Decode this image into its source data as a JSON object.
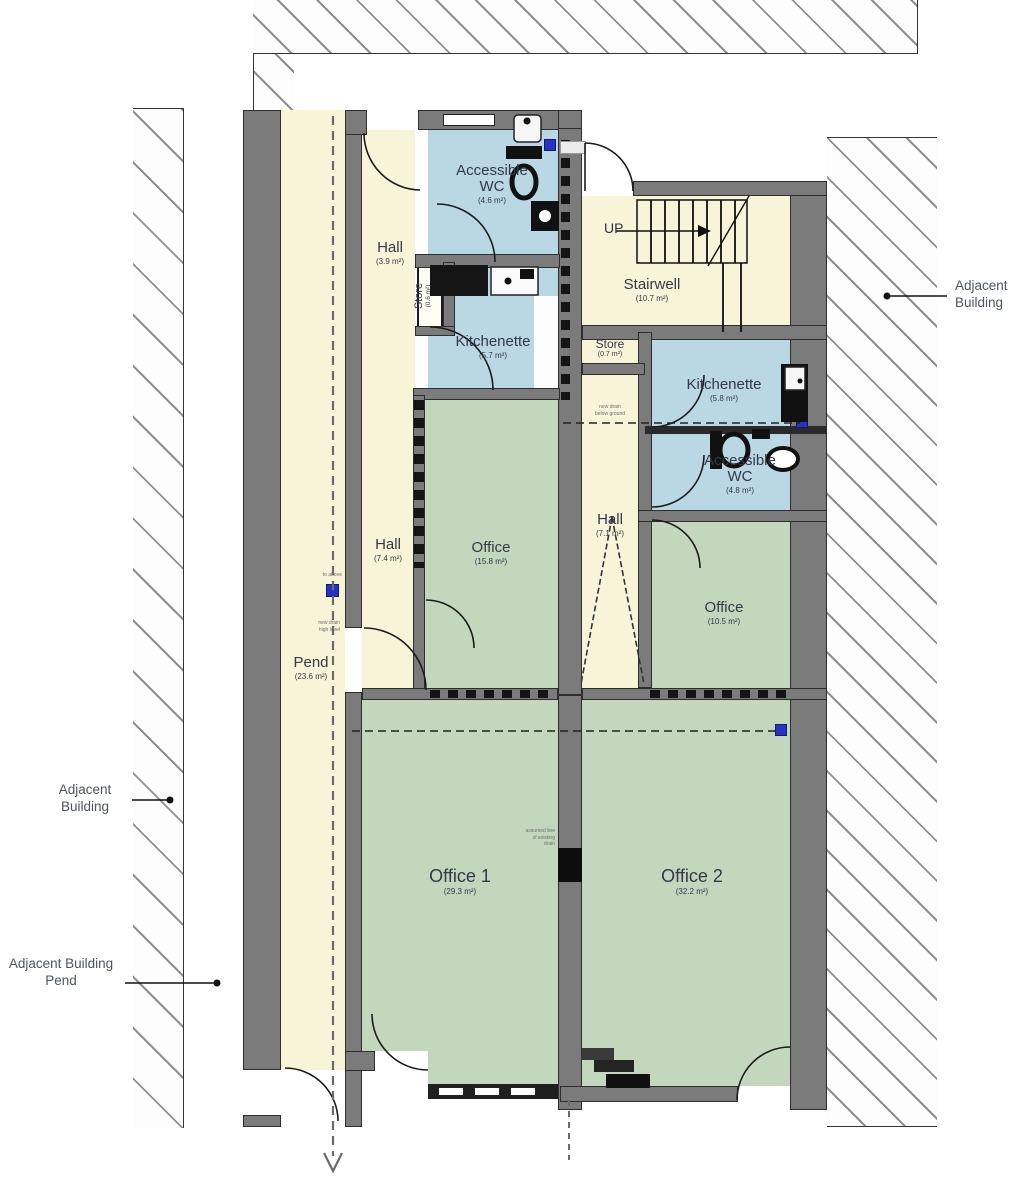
{
  "rooms": {
    "wc1": {
      "name": "Accessible WC",
      "area": "(4.6 m²)"
    },
    "hall1": {
      "name": "Hall",
      "area": "(3.9 m²)"
    },
    "store1": {
      "name": "Store",
      "area": "(0.6 m²)"
    },
    "kitchenette1": {
      "name": "Kitchenette",
      "area": "(5.7 m²)"
    },
    "stairwell": {
      "name": "Stairwell",
      "area": "(10.7 m²)"
    },
    "store2": {
      "name": "Store",
      "area": "(0.7 m²)"
    },
    "kitchenette2": {
      "name": "Kitchenette",
      "area": "(5.8 m²)"
    },
    "wc2": {
      "name": "Accessible WC",
      "area": "(4.8 m²)"
    },
    "hall2": {
      "name": "Hall",
      "area": "(7.4 m²)"
    },
    "office_a": {
      "name": "Office",
      "area": "(15.8 m²)"
    },
    "hall3": {
      "name": "Hall",
      "area": "(7.1 m²)"
    },
    "office_b": {
      "name": "Office",
      "area": "(10.5 m²)"
    },
    "pend": {
      "name": "Pend",
      "area": "(23.6 m²)"
    },
    "office1": {
      "name": "Office 1",
      "area": "(29.3 m²)"
    },
    "office2": {
      "name": "Office 2",
      "area": "(32.2 m²)"
    }
  },
  "annotations": {
    "up": "UP",
    "adjacent_building_left": "Adjacent Building",
    "adjacent_building_right": "Adjacent Building",
    "adjacent_building_pend": "Adjacent Building\nPend",
    "to_above": "to above",
    "new_drain_high": "new drain\nhigh level",
    "new_drain_below": "new drain\nbelow ground",
    "assumed_drain": "assumed line\nof existing\ndrain"
  },
  "colors": {
    "hall_fill": "#f7f4d8",
    "wet_room_fill": "#b9d8e4",
    "office_fill": "#c3d7bd",
    "wall": "#7b7b7b",
    "drain_marker": "#2533c4"
  }
}
